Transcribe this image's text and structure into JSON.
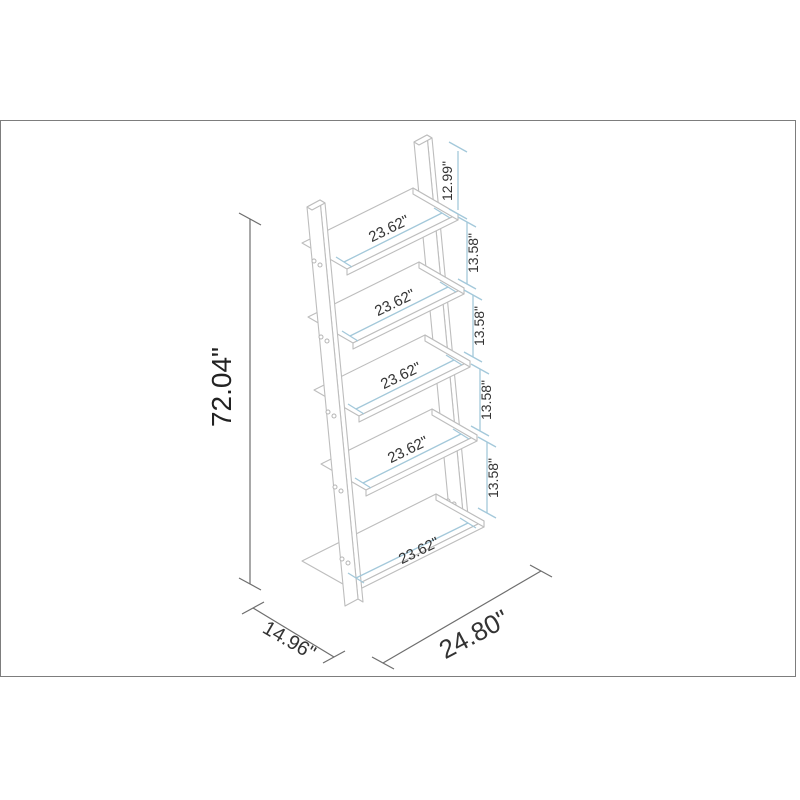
{
  "drawing": {
    "title": "ladder-bookcase-dimension-diagram",
    "units": "inches",
    "colors": {
      "dimension_blue": "#a3c8da",
      "dimension_dark": "#6e6e6e",
      "outline_gray": "#bdbdbd",
      "text": "#333333",
      "frame_border": "#7d7d7d",
      "background": "#ffffff"
    },
    "dimensions": {
      "overall_height": "72.04\"",
      "top_post_height": "12.99\"",
      "shelf_gaps": [
        "13.58\"",
        "13.58\"",
        "13.58\"",
        "13.58\""
      ],
      "shelf_widths": [
        "23.62\"",
        "23.62\"",
        "23.62\"",
        "23.62\"",
        "23.62\""
      ],
      "base_depth": "14.96\"",
      "base_width": "24.80\""
    }
  }
}
